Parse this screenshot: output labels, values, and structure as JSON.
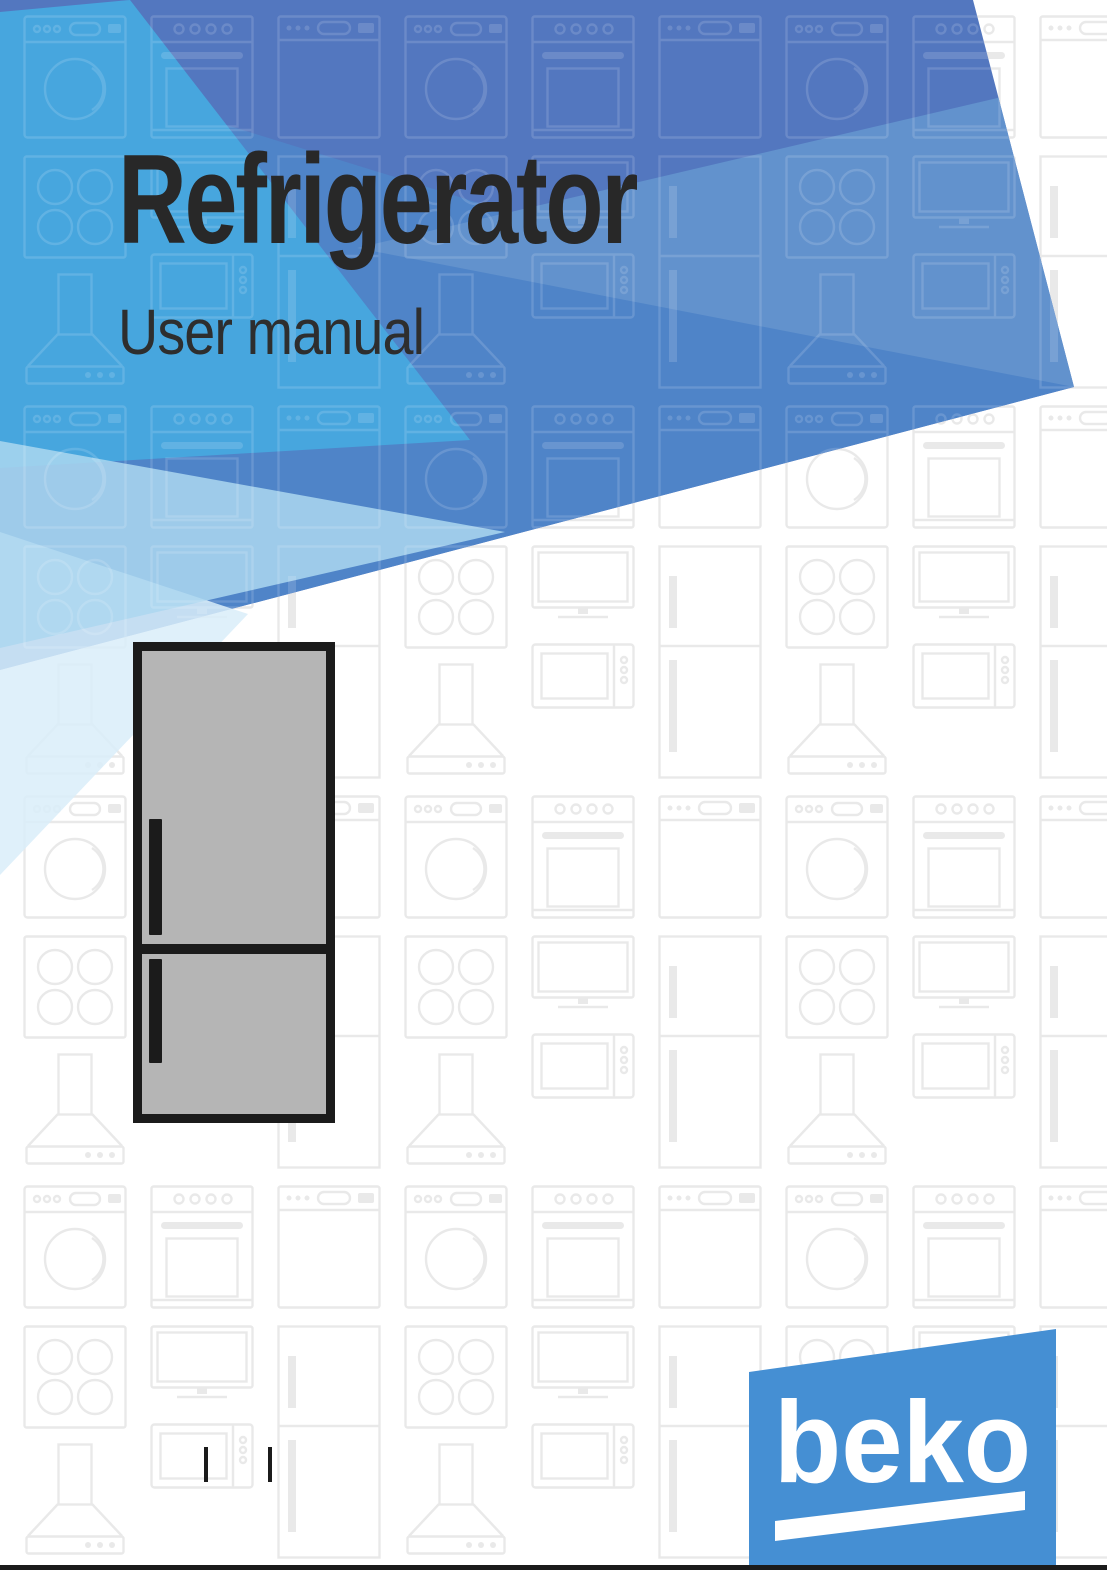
{
  "page": {
    "title": "Refrigerator",
    "subtitle": "User manual"
  },
  "brand": {
    "logo_text": "beko"
  },
  "illustration": {
    "name": "refrigerator-two-door-front-view",
    "doors": 2,
    "handle_side": "left"
  },
  "background": {
    "pattern_icons": [
      "washing-machine-icon",
      "oven-icon",
      "cooktop-icon",
      "tv-icon",
      "dishwasher-icon",
      "microwave-icon",
      "range-hood-icon",
      "fridge-outline-icon"
    ]
  },
  "footer": {
    "registration_marks": 2
  },
  "theme": {
    "header_dark": "#5377bf",
    "header_mid": "#4f84c8",
    "header_wedge": "#6292cd",
    "header_cyan": "#47a6de",
    "header_pale": "#abd7f0",
    "header_palest": "#d9edf9",
    "logo_blue": "#458fd3",
    "fridge_body": "#b5b5b5",
    "ink": "#1b1b1b",
    "title_color": "#282828",
    "subtitle_color": "#2e2e2e",
    "pattern_stroke": "#e9e9e9",
    "page_bg": "#ffffff"
  }
}
